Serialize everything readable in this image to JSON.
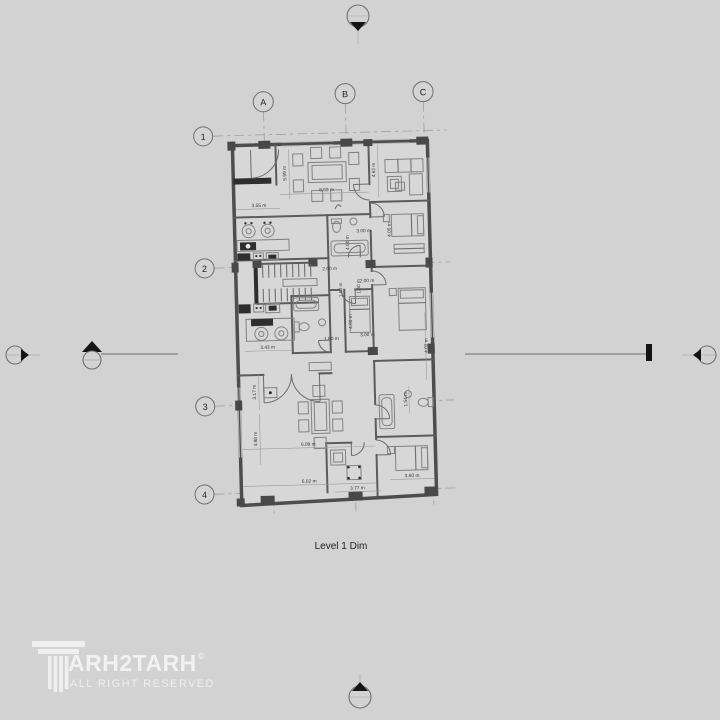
{
  "canvas": {
    "background": "#d2d2d2"
  },
  "colors": {
    "walls": "#4d4d4d",
    "marker_black": "#141414",
    "logo": "#f4f4f4"
  },
  "drawing": {
    "title": "Level 1 Dim",
    "grid_columns": [
      "A",
      "B",
      "C"
    ],
    "grid_rows": [
      "1",
      "2",
      "3",
      "4"
    ],
    "dimensions": {
      "entry_width": "3.55 m",
      "foyer_depth": "5.99 m",
      "living_width": "8.69 m",
      "sitting_depth": "4.62 m",
      "bed1_width": "3.00 m",
      "bed1_depth": "4.00 m",
      "bath1_depth": "4.00 m",
      "hall_width": "2.00 m",
      "corridor_width": "2.00 m",
      "stair_width": "1.60 m",
      "corridor_depth": "1.60 m",
      "bed2_depth": "4.00 m",
      "bed2_width": "3.00 m",
      "bath2_width": "1.80 m",
      "kitchen_width": "3.43 m",
      "bed3_depth": "4.02 m",
      "terrace_depth": "3.17 m",
      "living2_depth": "4.98 m",
      "living2_width": "6.09 m",
      "bottom_width": "6.02 m",
      "den_width": "3.77 m",
      "bed4_width": "3.60 m",
      "bath3_depth": "1.54 m"
    }
  },
  "watermark": {
    "letters": "ARH2TARH",
    "copyright_symbol": "©",
    "tagline": "ALL RIGHT RESERVED"
  }
}
